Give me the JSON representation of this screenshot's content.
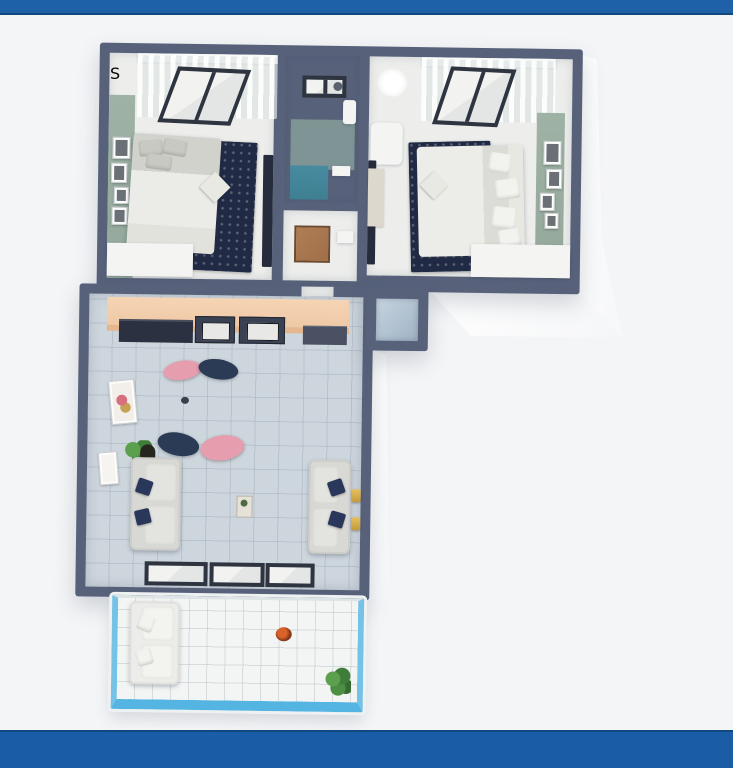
{
  "logo": {
    "letter": "S"
  },
  "colors": {
    "background": "#F4F5F7",
    "top_bar": "#1E61A9",
    "top_bar_edge": "#10497F",
    "bottom_bar": "#1A5CA5",
    "wall": "#57617A",
    "floor_light": "#EDEEEC",
    "floor_tile": "#CDD5DD",
    "accent_wall_green": "#93A89B",
    "rug_navy": "#212A44",
    "rug_blue": "#8AAED7",
    "kitchen_counter": "#F0C9A6",
    "appliance": "#2B3140",
    "sofa": "#D8D8D4",
    "pillow_navy": "#29375B",
    "chair_pink": "#E69DAE",
    "chair_navy": "#2B3A55",
    "shower_teal": "#3F7F92",
    "door_brown": "#A06F48",
    "balcony_glass": "#74C2E6",
    "gold": "#C29A3C",
    "window_frame": "#2E3440",
    "plant_green": "#3F7D3A",
    "logo_blue": "#2BA4D4",
    "exterior_white": "#FDFDFD"
  }
}
